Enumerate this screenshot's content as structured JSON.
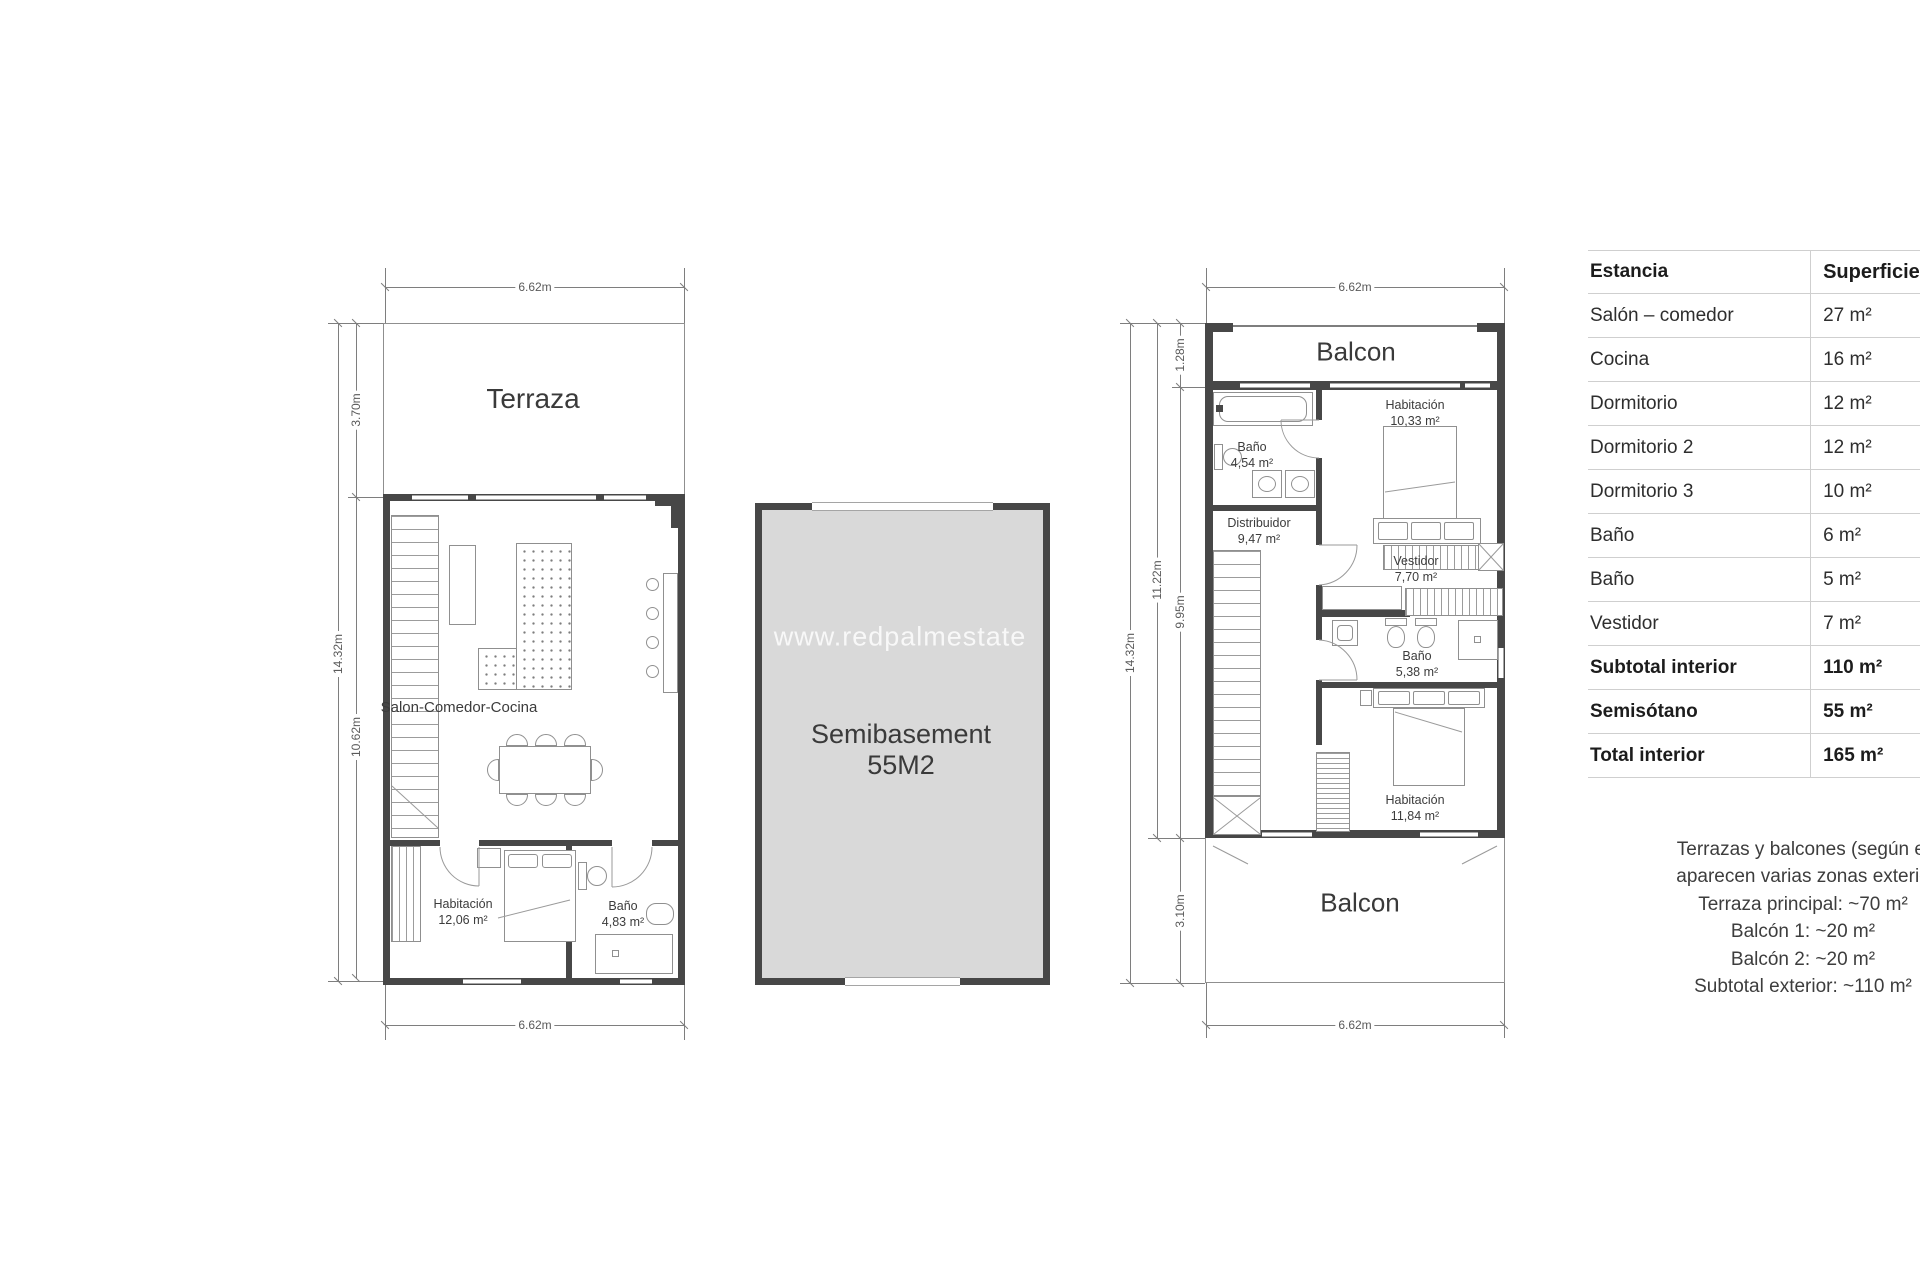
{
  "watermark_text": "www.redpalmestate",
  "ground_floor": {
    "terrace": "Terraza",
    "salon": "Salon-Comedor-Cocina",
    "bedroom": {
      "name": "Habitación",
      "area": "12,06 m²"
    },
    "bath": {
      "name": "Baño",
      "area": "4,83 m²"
    },
    "dim_top": "6.62m",
    "dim_bottom": "6.62m",
    "dim_total": "14.32m",
    "dim_terrace": "3.70m",
    "dim_interior": "10.62m"
  },
  "basement": {
    "line1": "Semibasement",
    "line2": "55M2"
  },
  "top_floor": {
    "balcony_top": "Balcon",
    "balcony_bottom": "Balcon",
    "bath1": {
      "name": "Baño",
      "area": "4,54 m²"
    },
    "bedroom1": {
      "name": "Habitación",
      "area": "10,33 m²"
    },
    "hall": {
      "name": "Distribuidor",
      "area": "9,47 m²"
    },
    "dressing": {
      "name": "Vestidor",
      "area": "7,70 m²"
    },
    "bath2": {
      "name": "Baño",
      "area": "5,38 m²"
    },
    "bedroom2": {
      "name": "Habitación",
      "area": "11,84 m²"
    },
    "dim_top": "6.62m",
    "dim_bottom": "6.62m",
    "dim_total": "14.32m",
    "dim_upper": "11.22m",
    "dim_interior": "9.95m",
    "dim_balc_top": "1.28m",
    "dim_balc_bottom": "3.10m"
  },
  "area_table": {
    "col1": "Estancia",
    "col2": "Superficie",
    "rows": [
      {
        "name": "Salón – comedor",
        "area": "27 m²"
      },
      {
        "name": "Cocina",
        "area": "16 m²"
      },
      {
        "name": "Dormitorio",
        "area": "12 m²"
      },
      {
        "name": "Dormitorio 2",
        "area": "12 m²"
      },
      {
        "name": "Dormitorio 3",
        "area": "10 m²"
      },
      {
        "name": "Baño",
        "area": "6 m²"
      },
      {
        "name": "Baño",
        "area": "5 m²"
      },
      {
        "name": "Vestidor",
        "area": "7 m²"
      },
      {
        "name": "Subtotal interior",
        "area": "110 m²"
      },
      {
        "name": "Semisótano",
        "area": "55 m²"
      },
      {
        "name": "Total interior",
        "area": "165 m²"
      }
    ]
  },
  "notes": {
    "line1": "Terrazas y balcones (según el",
    "line2": "aparecen varias zonas exterio",
    "line3": "Terraza principal: ~70 m²",
    "line4": "Balcón 1: ~20 m²",
    "line5": "Balcón 2: ~20 m²",
    "line6": "Subtotal exterior: ~110 m²"
  }
}
